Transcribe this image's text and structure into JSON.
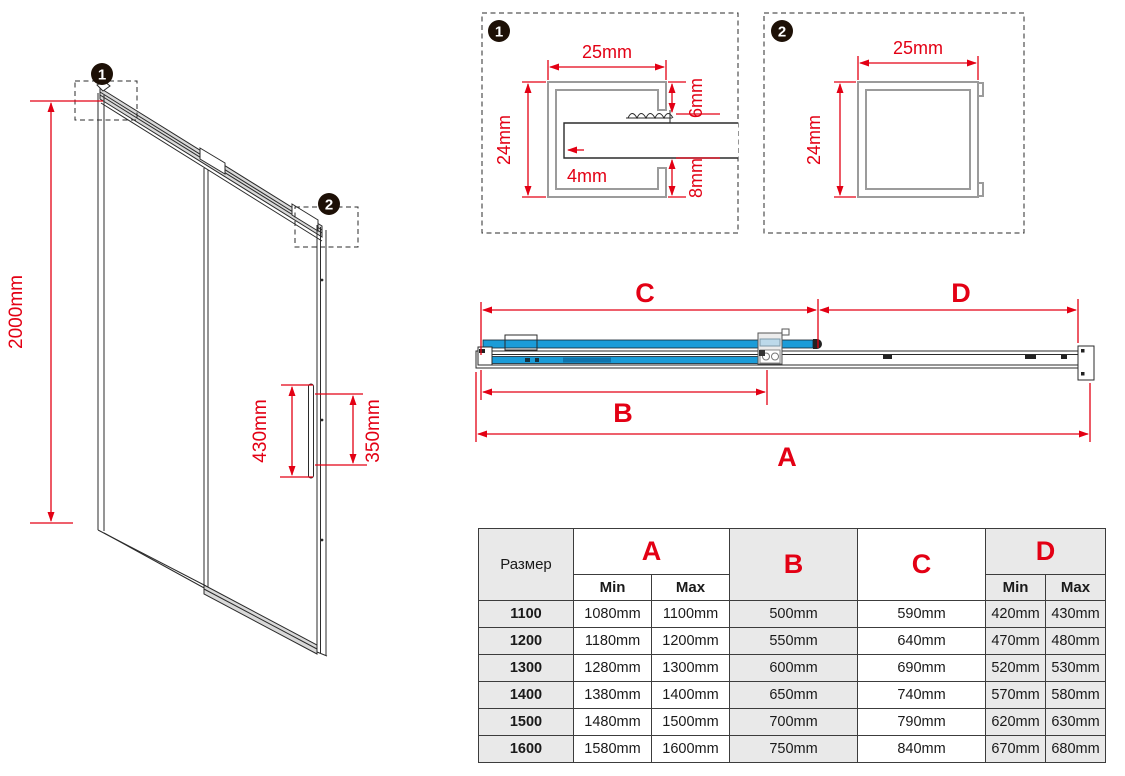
{
  "colors": {
    "accent_red": "#e30014",
    "glass_blue": "#1b9cd8",
    "table_gray": "#e9e9e9",
    "rail_gray": "#d9d9d9"
  },
  "iso": {
    "callout1": "1",
    "callout2": "2",
    "height": "2000mm",
    "handle_height": "430mm",
    "handle_offset": "350mm"
  },
  "d1": {
    "callout": "1",
    "width": "25mm",
    "height": "24mm",
    "top": "6mm",
    "wall": "4mm",
    "bottom": "8mm"
  },
  "d2": {
    "callout": "2",
    "width": "25mm",
    "height": "24mm"
  },
  "tv": {
    "a": "A",
    "b": "B",
    "c": "C",
    "d": "D"
  },
  "table": {
    "size_header": "Размер",
    "col_a": "A",
    "col_b": "B",
    "col_c": "C",
    "col_d": "D",
    "min": "Min",
    "max": "Max",
    "rows": [
      {
        "size": "1100",
        "a_min": "1080mm",
        "a_max": "1100mm",
        "b": "500mm",
        "c": "590mm",
        "d_min": "420mm",
        "d_max": "430mm"
      },
      {
        "size": "1200",
        "a_min": "1180mm",
        "a_max": "1200mm",
        "b": "550mm",
        "c": "640mm",
        "d_min": "470mm",
        "d_max": "480mm"
      },
      {
        "size": "1300",
        "a_min": "1280mm",
        "a_max": "1300mm",
        "b": "600mm",
        "c": "690mm",
        "d_min": "520mm",
        "d_max": "530mm"
      },
      {
        "size": "1400",
        "a_min": "1380mm",
        "a_max": "1400mm",
        "b": "650mm",
        "c": "740mm",
        "d_min": "570mm",
        "d_max": "580mm"
      },
      {
        "size": "1500",
        "a_min": "1480mm",
        "a_max": "1500mm",
        "b": "700mm",
        "c": "790mm",
        "d_min": "620mm",
        "d_max": "630mm"
      },
      {
        "size": "1600",
        "a_min": "1580mm",
        "a_max": "1600mm",
        "b": "750mm",
        "c": "840mm",
        "d_min": "670mm",
        "d_max": "680mm"
      }
    ]
  }
}
